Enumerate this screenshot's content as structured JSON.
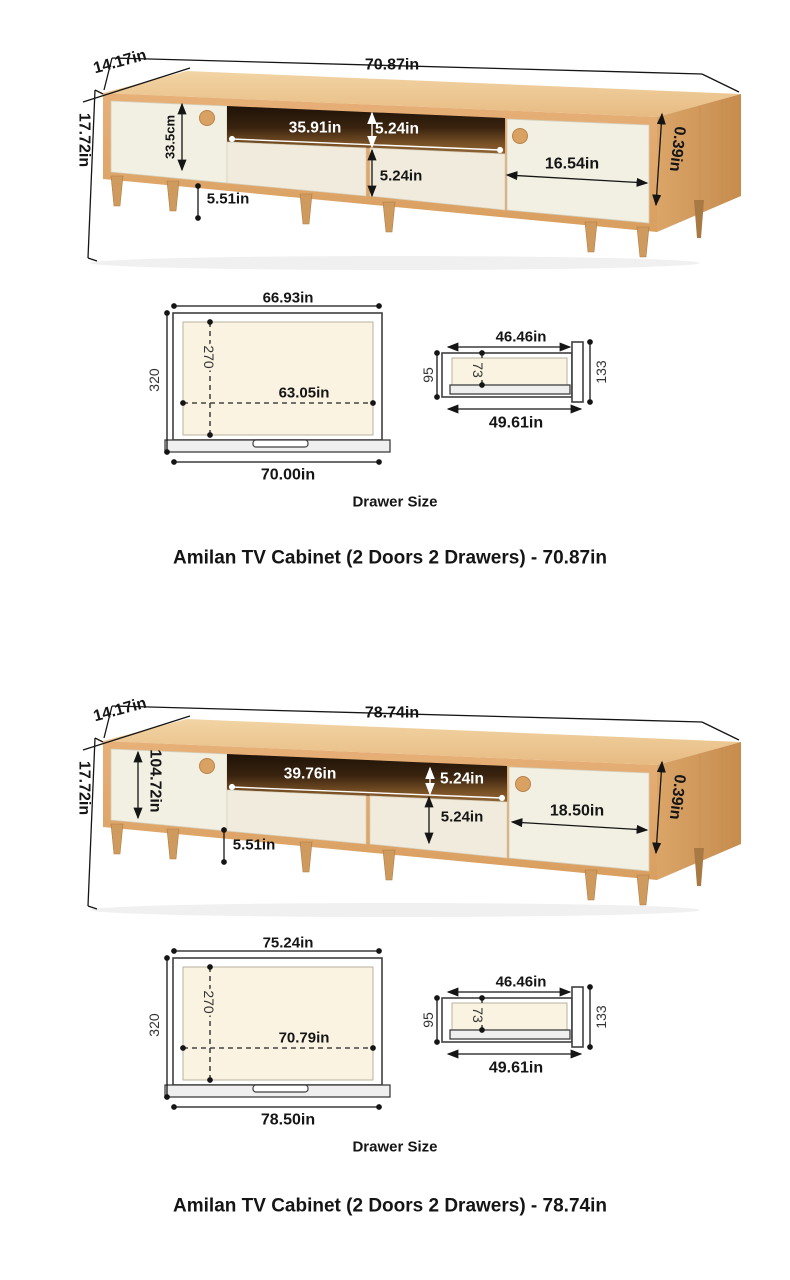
{
  "c1": {
    "caption": "Amilan TV Cabinet (2 Doors 2 Drawers) - 70.87in",
    "drawer_size_label": "Drawer Size",
    "total_width": "70.87in",
    "depth": "14.17in",
    "height": "17.72in",
    "left_door_dim": "33.5cm",
    "opening_width": "35.91in",
    "opening_height": "5.24in",
    "drawer_front_height": "5.24in",
    "right_door_width": "16.54in",
    "leg_height": "5.51in",
    "panel_thickness": "0.39in",
    "drawer_front": {
      "inner_width": "66.93in",
      "height": "320",
      "inner_height": "270",
      "inner_width_2": "63.05in",
      "outer_width": "70.00in"
    },
    "drawer_side": {
      "top_width": "46.46in",
      "height": "95",
      "inner_height": "73",
      "front_height": "133",
      "bottom_width": "49.61in"
    }
  },
  "c2": {
    "caption": "Amilan TV Cabinet (2 Doors 2 Drawers) - 78.74in",
    "drawer_size_label": "Drawer Size",
    "total_width": "78.74in",
    "depth": "14.17in",
    "height": "17.72in",
    "left_door_dim": "104.72in",
    "opening_width": "39.76in",
    "opening_height": "5.24in",
    "drawer_front_height": "5.24in",
    "right_door_width": "18.50in",
    "leg_height": "5.51in",
    "panel_thickness": "0.39in",
    "drawer_front": {
      "inner_width": "75.24in",
      "height": "320",
      "inner_height": "270",
      "inner_width_2": "70.79in",
      "outer_width": "78.50in"
    },
    "drawer_side": {
      "top_width": "46.46in",
      "height": "95",
      "inner_height": "73",
      "front_height": "133",
      "bottom_width": "49.61in"
    }
  }
}
